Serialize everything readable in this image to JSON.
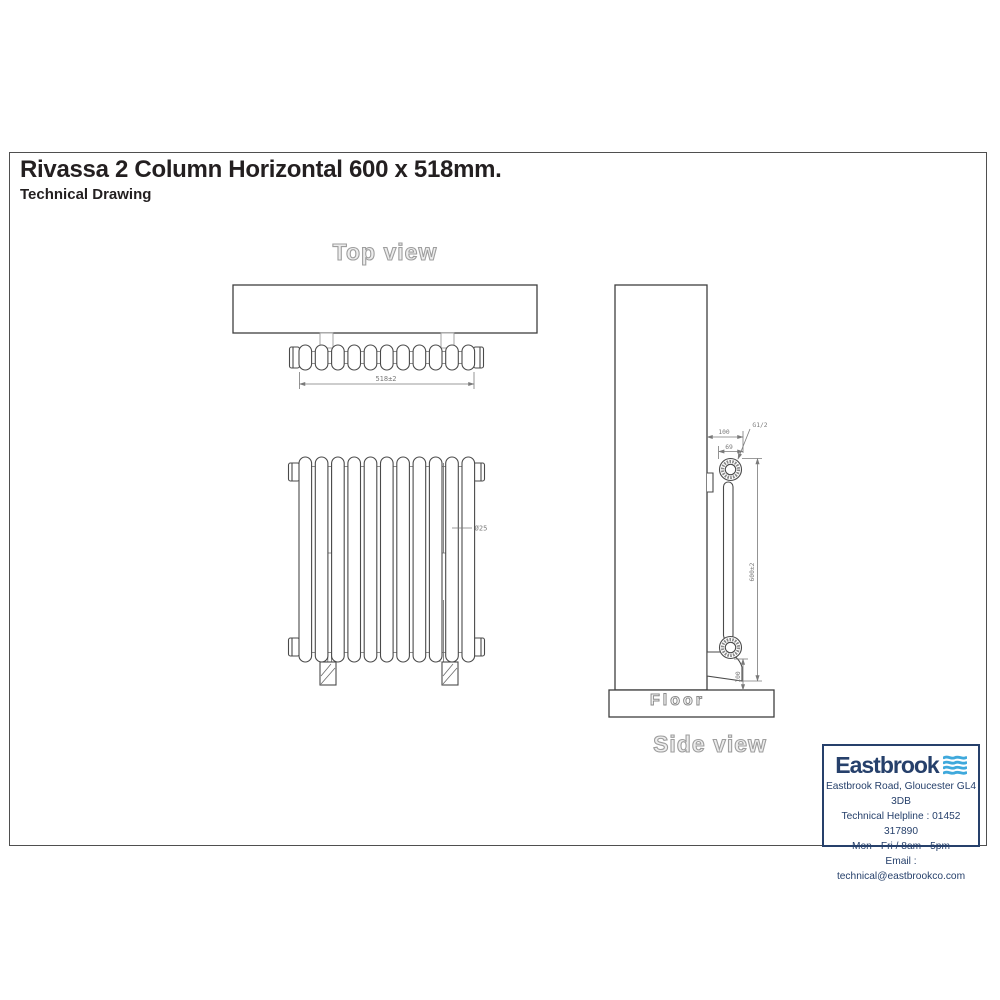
{
  "page": {
    "title": "Rivassa 2 Column Horizontal 600 x 518mm.",
    "subtitle": "Technical Drawing"
  },
  "views": {
    "top": {
      "label": "Top view",
      "width_dim": "518±2"
    },
    "front": {
      "column_diameter_dim": "Ø25"
    },
    "side": {
      "label": "Side view",
      "floor_label": "Floor",
      "depth_overall_dim": "100",
      "depth_dim": "69",
      "connection_dim": "G1/2",
      "height_dim": "600±2",
      "floor_clearance_dim": "100"
    }
  },
  "supplier": {
    "brand": "Eastbrook",
    "address": "Eastbrook Road, Gloucester GL4 3DB",
    "helpline": "Technical Helpline : 01452 317890",
    "hours": "Mon - Fri / 8am - 5pm",
    "email": "Email : technical@eastbrookco.com"
  },
  "colors": {
    "brand_navy": "#26406b",
    "wave_blue": "#3fa9dc",
    "line_dark": "#4a4a4a",
    "line_dim": "#7a7a7a",
    "outline_label": "#9e9e9e"
  }
}
